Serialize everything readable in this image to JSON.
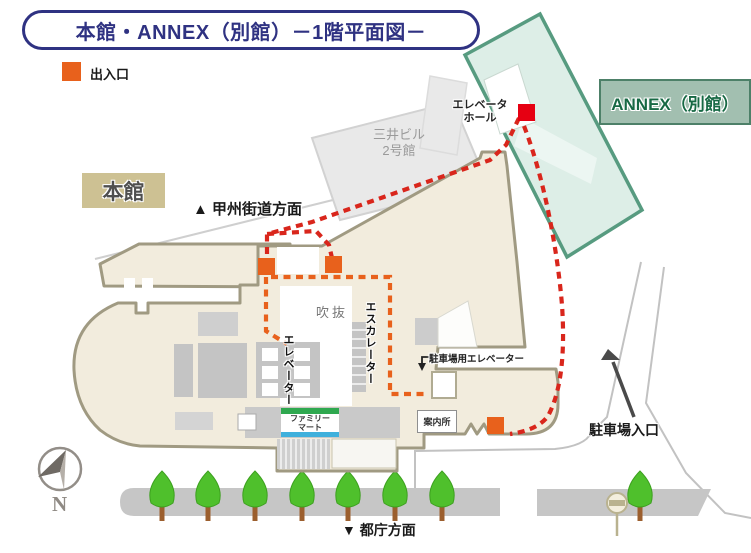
{
  "title": "本館・ANNEX（別館）－1階平面図－",
  "legend": {
    "label": "出入口",
    "color": "#e8611c"
  },
  "buildings": {
    "annex": {
      "label": "ANNEX（別館）"
    },
    "honkan": {
      "label": "本館"
    },
    "mitsui": {
      "name_line1": "三井ビル",
      "name_line2": "2号館"
    }
  },
  "directions": {
    "north_road": "▲ 甲州街道方面",
    "south_road": "▼ 都庁方面",
    "parking_entrance": "駐車場入口"
  },
  "facilities": {
    "elevator_hall_line1": "エレベータ",
    "elevator_hall_line2": "ホール",
    "atrium": "吹抜",
    "escalator": "エスカレーター",
    "elevator": "エレベーター",
    "parking_elevator": "駐車場用エレベーター",
    "information": "案内所",
    "store_line1": "ファミリー",
    "store_line2": "マート"
  },
  "compass": {
    "label": "N"
  },
  "colors": {
    "title_navy": "#2f3282",
    "exit_orange": "#e8611c",
    "annex_exit_red": "#e60012",
    "route_red": "#d9261c",
    "route_orange": "#e8611c",
    "annex_fill": "#ddeee7",
    "annex_stroke": "#579b80",
    "annex_label_bg": "#a2bfb0",
    "building_fill": "#f2ecdd",
    "building_stroke": "#a09a82",
    "honkan_label_bg": "#cdc193",
    "sidewalk_gray": "#c6c6c6",
    "tree_green": "#4fc02c",
    "familymart_green": "#2fa84f",
    "familymart_blue": "#3fb0dc"
  },
  "map": {
    "exit_markers": [
      {
        "x": 258,
        "y": 258
      },
      {
        "x": 325,
        "y": 256
      },
      {
        "x": 487,
        "y": 417
      }
    ],
    "annex_exit_marker": {
      "x": 518,
      "y": 104
    },
    "marker_size": 17,
    "trees": {
      "xs": [
        162,
        208,
        255,
        302,
        348,
        395,
        442,
        640
      ],
      "base_y": 517
    }
  }
}
